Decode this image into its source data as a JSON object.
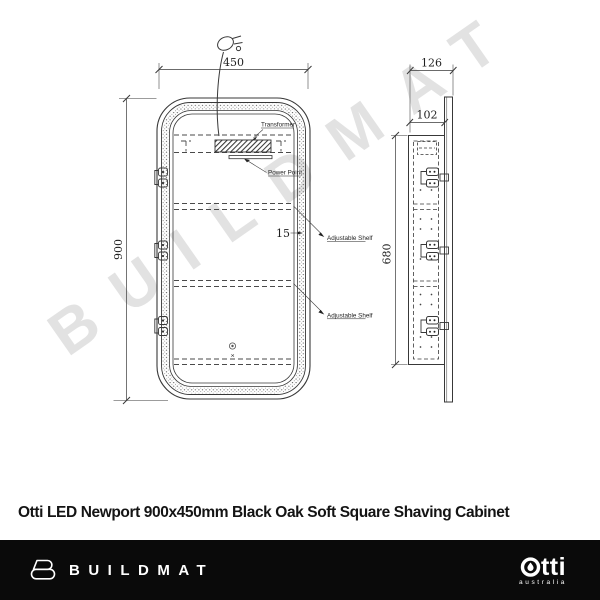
{
  "watermark": "BUILDMAT",
  "title": "Otti LED Newport 900x450mm Black Oak Soft Square Shaving Cabinet",
  "drawing": {
    "dims": {
      "front_width": "450",
      "front_height": "900",
      "side_overall_depth": "126",
      "side_body_depth": "102",
      "side_body_height": "680",
      "frame_thickness": "15"
    },
    "labels": {
      "transformer": "Transformer",
      "power_point": "Power Point",
      "adjustable_shelf_1": "Adjustable Shelf",
      "adjustable_shelf_2": "Adjustable Shelf"
    }
  },
  "footer": {
    "buildmat_wordmark": "BUILDMAT",
    "otti_wordmark": "otti",
    "otti_wordmark_tail": "tti",
    "otti_subtext": "australia"
  },
  "colors": {
    "line": "#383838",
    "footer_bg": "#0a0a0a",
    "watermark": "#e2e2e2",
    "text": "#141414"
  }
}
